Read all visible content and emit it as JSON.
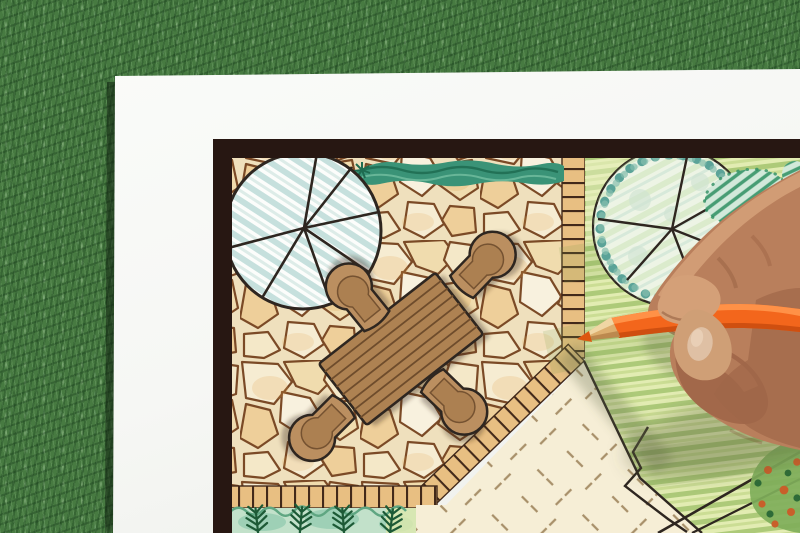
{
  "scene": {
    "description": "Overhead photo: a hand holding an orange colored pencil draws a landscape garden plan on a white sheet that lies on green artificial grass",
    "background": "green grass lawn",
    "paper": "white sheet with hand-drawn garden plan inside a dark frame border",
    "hand": "right hand entering from the right edge, gripping an orange pencil",
    "pencil": "orange colored pencil, sharpened tip touching the patio corner of the plan",
    "plan_elements": [
      "round shade tree with radiating branch lines (top left)",
      "green hedge strip along top edge",
      "flagstone patio of irregular stones",
      "brick tile border course around patio edges",
      "rectangular wooden dining table with plank lines",
      "four rounded patio chairs",
      "lawn tree with scalloped canopy and spokes (top right)",
      "dark green hatched shrub",
      "striped crayon lawn",
      "pale paving area with dashed cross hatch marks",
      "fern planting bed along bottom left",
      "flower bed with orange blossoms (bottom right)",
      "black garden path lines"
    ]
  },
  "colors": {
    "grass-base": "#477a41",
    "grass-dark": "#2d5a2d",
    "grass-light": "#6fa661",
    "paper": "#f6f7f4",
    "frame": "#271712",
    "ink": "#2e2620",
    "stone-bg": "#efe0bd",
    "stone-line": "#7b4a26",
    "stone-a": "#f6ecd2",
    "stone-b": "#f0dcae",
    "stone-c": "#f4e8c8",
    "stone-d": "#eecf9a",
    "stone-e": "#f8f1de",
    "band-base": "#e8bf82",
    "band-line": "#42291a",
    "hedge-base": "#3a9377",
    "hedge-dark": "#1e6b50",
    "hedge-light": "#7cc4a6",
    "tree1-hatch-a": "#8fc4bf",
    "tree1-hatch-b": "#c2ded9",
    "lawn-base": "#e2ecb2",
    "lawn-stripe-a": "#a3c46e",
    "lawn-stripe-b": "#c6d98c",
    "pale-base": "#f6eed6",
    "pale-dash": "#a8906a",
    "scallop-a": "#5ba398",
    "scallop-b": "#86beae",
    "tree2-wash": "#edf4e5",
    "tree2-streak": "#aed292",
    "bush-base": "#d2e9da",
    "bush-hatch": "#2f8f63",
    "fern": "#1d5a36",
    "bed-wash-a": "#c2e1ca",
    "bed-wash-b": "#8fc9ae",
    "bed-green": "#5fa682",
    "flowerbed-green": "#7fae5a",
    "flower-orange": "#c85f2a",
    "flower-dark": "#2e6b38",
    "table-wood": "#ae8252",
    "table-line": "#6e4c2c",
    "chair-wood": "#bb8f60",
    "chair-seat": "#ab7f50",
    "skin-light": "#d4a078",
    "skin-mid": "#b97f5c",
    "skin-dark": "#a06648",
    "skin-thumb": "#cf9f76",
    "nail": "#dfc0a4",
    "pencil-hi": "#ff944a",
    "pencil-mid": "#f3661c",
    "pencil-dark": "#cf4f10",
    "wood-light": "#f0d6a4",
    "wood-mid": "#dcae6e",
    "wood-dark": "#b8854a",
    "pencil-core": "#dd570f"
  }
}
